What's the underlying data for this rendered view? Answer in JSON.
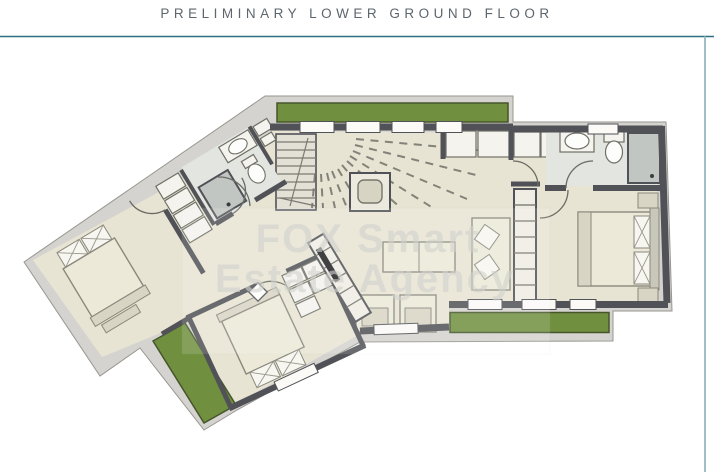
{
  "page": {
    "title": "PRELIMINARY LOWER GROUND FLOOR"
  },
  "watermark": {
    "line1": "FOX Smart",
    "line2": "Estate Agency"
  },
  "colors": {
    "frame_top": "#2d7086",
    "frame_right": "#9ec0c6",
    "title_text": "#5d666d",
    "wall_band": "#d4d3cf",
    "wall_line": "#515257",
    "floor": "#e8e4d3",
    "bath_floor": "#e2e5e0",
    "planter_green": "#70903f",
    "planter_border": "#46552c",
    "fixture_white": "#f4f3ee",
    "furniture_tan": "#ece9d8",
    "shower_gray": "#c2c6c2",
    "tv_black": "#222224",
    "watermark_gray": "#d2d3ce"
  }
}
